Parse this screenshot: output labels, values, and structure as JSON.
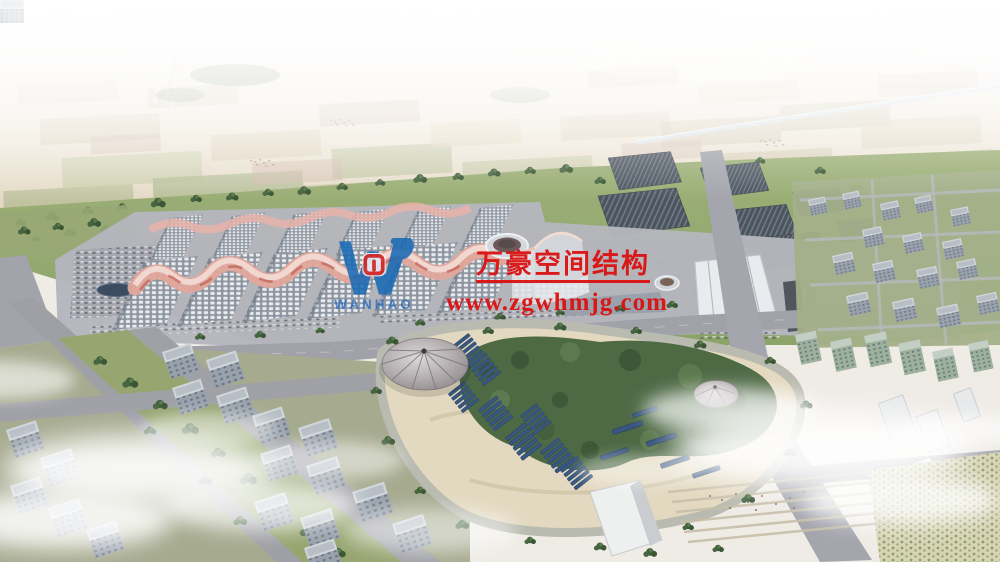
{
  "watermark": {
    "company_name": "万豪空间结构",
    "website": "www.zgwhmjg.com",
    "logo_text": "WANHAO",
    "logo_icon": "wanhao-w-logo",
    "text_color": "#dc1111",
    "logo_color": "#1a6ab5"
  }
}
